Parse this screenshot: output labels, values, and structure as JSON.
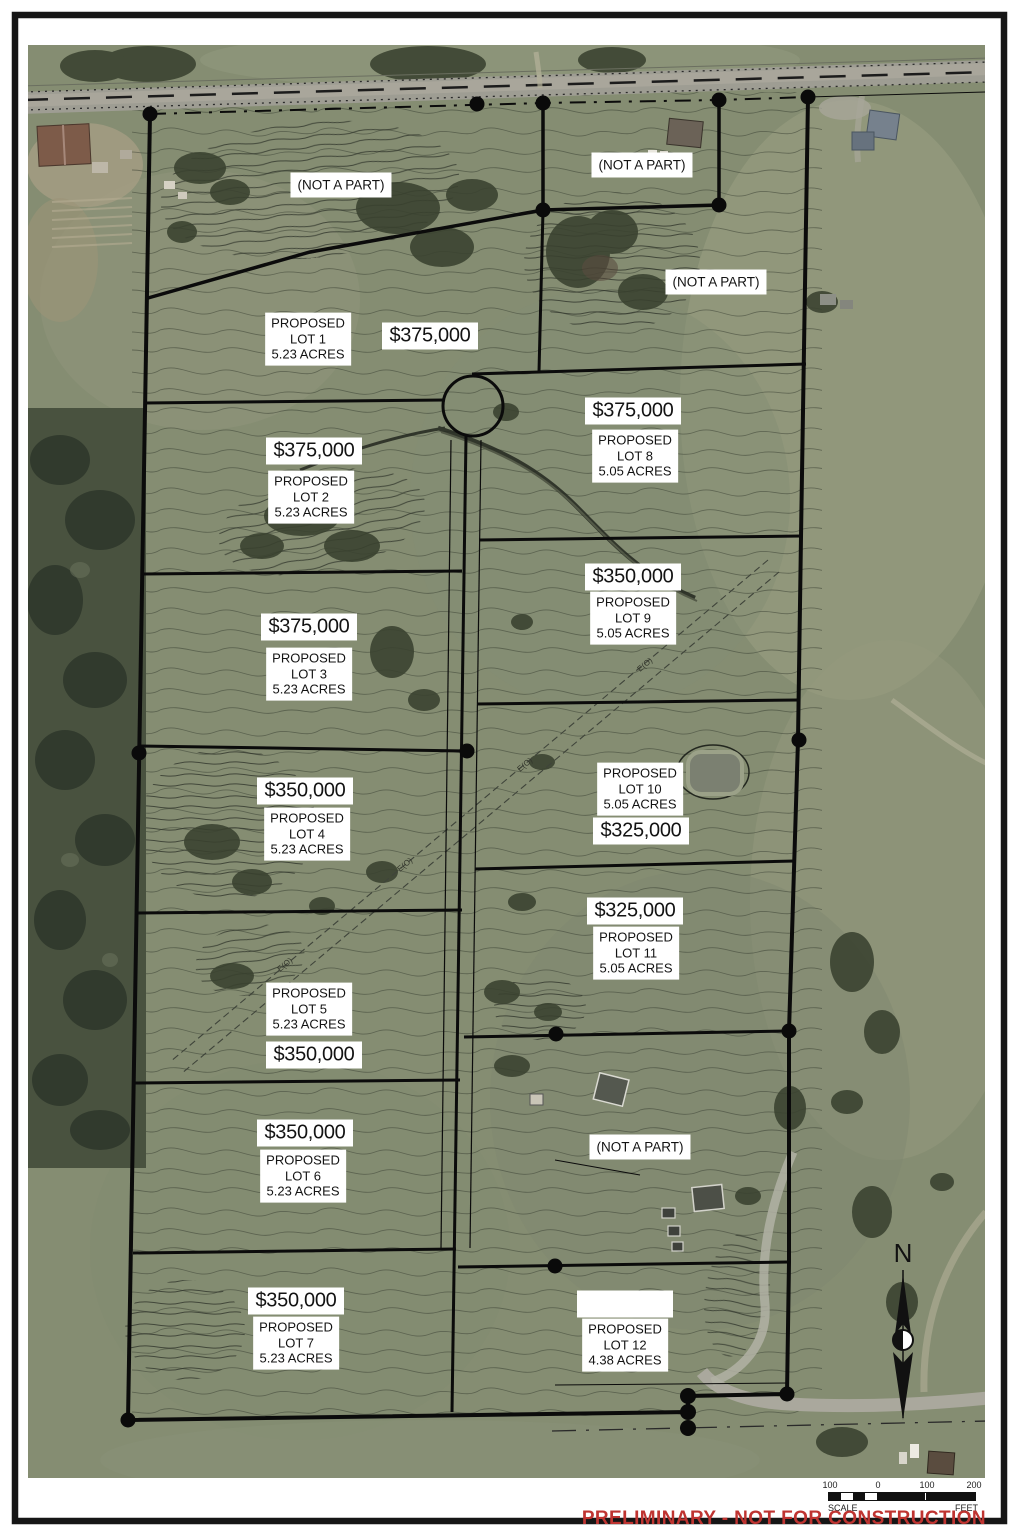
{
  "footer": {
    "disclaimer": "PRELIMINARY - NOT FOR CONSTRUCTION"
  },
  "scale_bar": {
    "labels": [
      "100",
      "0",
      "100",
      "200"
    ],
    "scale_word": "SCALE",
    "unit_word": "FEET"
  },
  "north": {
    "label": "N"
  },
  "map": {
    "easement_label": "E(O)"
  },
  "not_a_part": [
    {
      "text": "(NOT A PART)"
    },
    {
      "text": "(NOT A PART)"
    },
    {
      "text": "(NOT A PART)"
    },
    {
      "text": "(NOT A PART)"
    }
  ],
  "lots": [
    {
      "proposed": "PROPOSED",
      "lot": "LOT 1",
      "acres": "5.23 ACRES",
      "price": "$375,000"
    },
    {
      "proposed": "PROPOSED",
      "lot": "LOT 2",
      "acres": "5.23 ACRES",
      "price": "$375,000"
    },
    {
      "proposed": "PROPOSED",
      "lot": "LOT 3",
      "acres": "5.23 ACRES",
      "price": "$375,000"
    },
    {
      "proposed": "PROPOSED",
      "lot": "LOT 4",
      "acres": "5.23 ACRES",
      "price": "$350,000"
    },
    {
      "proposed": "PROPOSED",
      "lot": "LOT 5",
      "acres": "5.23 ACRES",
      "price": "$350,000"
    },
    {
      "proposed": "PROPOSED",
      "lot": "LOT 6",
      "acres": "5.23 ACRES",
      "price": "$350,000"
    },
    {
      "proposed": "PROPOSED",
      "lot": "LOT 7",
      "acres": "5.23 ACRES",
      "price": "$350,000"
    },
    {
      "proposed": "PROPOSED",
      "lot": "LOT 8",
      "acres": "5.05 ACRES",
      "price": "$375,000"
    },
    {
      "proposed": "PROPOSED",
      "lot": "LOT 9",
      "acres": "5.05 ACRES",
      "price": "$350,000"
    },
    {
      "proposed": "PROPOSED",
      "lot": "LOT 10",
      "acres": "5.05 ACRES",
      "price": "$325,000"
    },
    {
      "proposed": "PROPOSED",
      "lot": "LOT 11",
      "acres": "5.05 ACRES",
      "price": "$325,000"
    },
    {
      "proposed": "PROPOSED",
      "lot": "LOT 12",
      "acres": "4.38 ACRES",
      "price": ""
    }
  ],
  "colors": {
    "boundary": "#0b0b0b",
    "label_bg": "#ffffff",
    "disclaimer_red": "#bf3431",
    "field_green": "#858d72",
    "forest_green": "#49523f",
    "road_gray": "#9e9d93"
  }
}
